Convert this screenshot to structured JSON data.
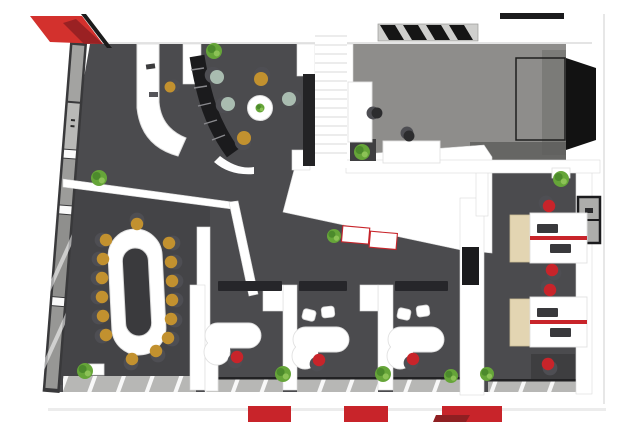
{
  "scene": {
    "type": "3d-office-floor-plan-top-view",
    "style": "architectural render, white walls, gray carpet, red accents"
  },
  "palette": {
    "wall": "#ffffff",
    "wall_shadow": "#dcdcdc",
    "carpet": "#4b4b4e",
    "carpet_conference": "#444447",
    "floor_room": "#8e8d8b",
    "accent_red": "#c8242a",
    "roof_red": "#d3312d",
    "roof_red_dark": "#8f1f22",
    "mustard": "#c2912f",
    "sage": "#a9bcb0",
    "plant": "#66a539",
    "plant_dark": "#4c8a2c",
    "plant_light": "#8cc256",
    "black": "#1b1b1d",
    "dark_furniture": "#2c2c2e",
    "glass_frame": "#39393b",
    "window_pane": "#b7b7b5",
    "wood": "#e3d5b2",
    "chair_back": "#4e4e53",
    "doormat": "#26262a",
    "mat_red": "#c8242a"
  },
  "rooms": [
    {
      "id": "reception",
      "furniture": [
        "curved-reception-desk",
        "task-chair",
        "curved-black-stair"
      ]
    },
    {
      "id": "lounge",
      "furniture": [
        "round-coffee-table",
        "armchairs-x5",
        "plant"
      ]
    },
    {
      "id": "meeting-room",
      "furniture": [
        "cabinet",
        "desk",
        "black-chairs-x2",
        "skylight",
        "black-panel"
      ]
    },
    {
      "id": "staircase",
      "furniture": [
        "straight-stair"
      ]
    },
    {
      "id": "conference-room",
      "furniture": [
        "ring-conference-table",
        "chairs-x15",
        "plant"
      ]
    },
    {
      "id": "office-1",
      "furniture": [
        "curved-desk",
        "task-chair"
      ]
    },
    {
      "id": "office-2",
      "furniture": [
        "curved-desk",
        "task-chair",
        "guest-chairs-x2"
      ]
    },
    {
      "id": "office-3",
      "furniture": [
        "curved-desk",
        "task-chair",
        "guest-chairs-x2"
      ]
    },
    {
      "id": "open-office-wing",
      "furniture": [
        "workstation-x2",
        "task-chairs-x4",
        "glass-partition",
        "plants"
      ]
    }
  ],
  "counts": {
    "conference_chairs": 15,
    "lounge_armchairs": 5,
    "red_task_chairs": 7,
    "guest_chairs": 4,
    "plants": 11,
    "entrance_mats": 3
  },
  "furniture": {
    "conference_chairs": [
      {
        "x": 106,
        "y": 240,
        "dx": -4,
        "dy": 0,
        "c": "mustard"
      },
      {
        "x": 103,
        "y": 259,
        "dx": -4,
        "dy": 0,
        "c": "mustard"
      },
      {
        "x": 102,
        "y": 278,
        "dx": -4,
        "dy": 0,
        "c": "mustard"
      },
      {
        "x": 102,
        "y": 297,
        "dx": -4,
        "dy": 0,
        "c": "mustard"
      },
      {
        "x": 103,
        "y": 316,
        "dx": -4,
        "dy": 1,
        "c": "mustard"
      },
      {
        "x": 106,
        "y": 335,
        "dx": -4,
        "dy": 1,
        "c": "mustard"
      },
      {
        "x": 169,
        "y": 243,
        "dx": 4,
        "dy": 0,
        "c": "mustard"
      },
      {
        "x": 171,
        "y": 262,
        "dx": 4,
        "dy": 0,
        "c": "mustard"
      },
      {
        "x": 172,
        "y": 281,
        "dx": 4,
        "dy": 0,
        "c": "mustard"
      },
      {
        "x": 172,
        "y": 300,
        "dx": 4,
        "dy": 0,
        "c": "mustard"
      },
      {
        "x": 171,
        "y": 319,
        "dx": 4,
        "dy": 1,
        "c": "mustard"
      },
      {
        "x": 168,
        "y": 338,
        "dx": 4,
        "dy": 1,
        "c": "mustard"
      },
      {
        "x": 137,
        "y": 224,
        "dx": 0,
        "dy": -4,
        "c": "mustard"
      },
      {
        "x": 132,
        "y": 359,
        "dx": -1,
        "dy": 4,
        "c": "mustard"
      },
      {
        "x": 156,
        "y": 351,
        "dx": 2,
        "dy": 4,
        "c": "mustard"
      }
    ],
    "lounge_chairs": [
      {
        "x": 217,
        "y": 77,
        "dx": -4,
        "dy": -2,
        "c": "sage",
        "r": 9
      },
      {
        "x": 228,
        "y": 104,
        "dx": -4,
        "dy": 1,
        "c": "sage",
        "r": 9
      },
      {
        "x": 289,
        "y": 99,
        "dx": 4,
        "dy": -1,
        "c": "sage",
        "r": 9
      },
      {
        "x": 261,
        "y": 79,
        "dx": 1,
        "dy": -4,
        "c": "mustard",
        "r": 9
      },
      {
        "x": 244,
        "y": 138,
        "dx": -1,
        "dy": 4,
        "c": "mustard",
        "r": 9
      }
    ],
    "reception_chair": [
      {
        "x": 170,
        "y": 87,
        "dx": 4,
        "dy": -1,
        "c": "mustard",
        "r": 7
      }
    ],
    "task_chairs": [
      {
        "x": 237,
        "y": 357,
        "dx": -2,
        "dy": 4,
        "c": "accent_red"
      },
      {
        "x": 319,
        "y": 360,
        "dx": -2,
        "dy": 4,
        "c": "accent_red"
      },
      {
        "x": 413,
        "y": 359,
        "dx": -2,
        "dy": 4,
        "c": "accent_red"
      },
      {
        "x": 549,
        "y": 206,
        "dx": -3,
        "dy": -3,
        "c": "accent_red"
      },
      {
        "x": 552,
        "y": 270,
        "dx": 2,
        "dy": 3,
        "c": "accent_red"
      },
      {
        "x": 550,
        "y": 290,
        "dx": -2,
        "dy": -3,
        "c": "accent_red"
      },
      {
        "x": 548,
        "y": 364,
        "dx": 2,
        "dy": 4,
        "c": "accent_red"
      }
    ],
    "black_chairs": [
      {
        "x": 377,
        "y": 113,
        "dx": -4,
        "dy": 0,
        "c": "dark_furniture",
        "r": 7
      },
      {
        "x": 409,
        "y": 136,
        "dx": -2,
        "dy": -3,
        "c": "dark_furniture",
        "r": 7
      }
    ],
    "guest_chairs": [
      {
        "x": 309,
        "y": 315,
        "rot": 14
      },
      {
        "x": 328,
        "y": 312,
        "rot": -6
      },
      {
        "x": 404,
        "y": 314,
        "rot": 12
      },
      {
        "x": 423,
        "y": 311,
        "rot": -8
      }
    ],
    "plants": [
      {
        "x": 214,
        "y": 51,
        "r": 8
      },
      {
        "x": 99,
        "y": 178,
        "r": 8
      },
      {
        "x": 362,
        "y": 152,
        "r": 8
      },
      {
        "x": 561,
        "y": 179,
        "r": 8
      },
      {
        "x": 334,
        "y": 236,
        "r": 7
      },
      {
        "x": 283,
        "y": 374,
        "r": 8
      },
      {
        "x": 383,
        "y": 374,
        "r": 8
      },
      {
        "x": 451,
        "y": 376,
        "r": 7
      },
      {
        "x": 487,
        "y": 374,
        "r": 7
      },
      {
        "x": 85,
        "y": 371,
        "r": 8
      },
      {
        "x": 260,
        "y": 108,
        "r": 4.5
      }
    ],
    "entrance_mats": [
      {
        "x": 248,
        "y": 406,
        "w": 43,
        "h": 16
      },
      {
        "x": 344,
        "y": 406,
        "w": 44,
        "h": 16
      },
      {
        "x": 442,
        "y": 406,
        "w": 60,
        "h": 16
      }
    ],
    "door_mats": [
      {
        "x": 218,
        "y": 281,
        "w": 64,
        "h": 10
      },
      {
        "x": 299,
        "y": 281,
        "w": 48,
        "h": 10
      },
      {
        "x": 395,
        "y": 281,
        "w": 53,
        "h": 10
      }
    ]
  }
}
